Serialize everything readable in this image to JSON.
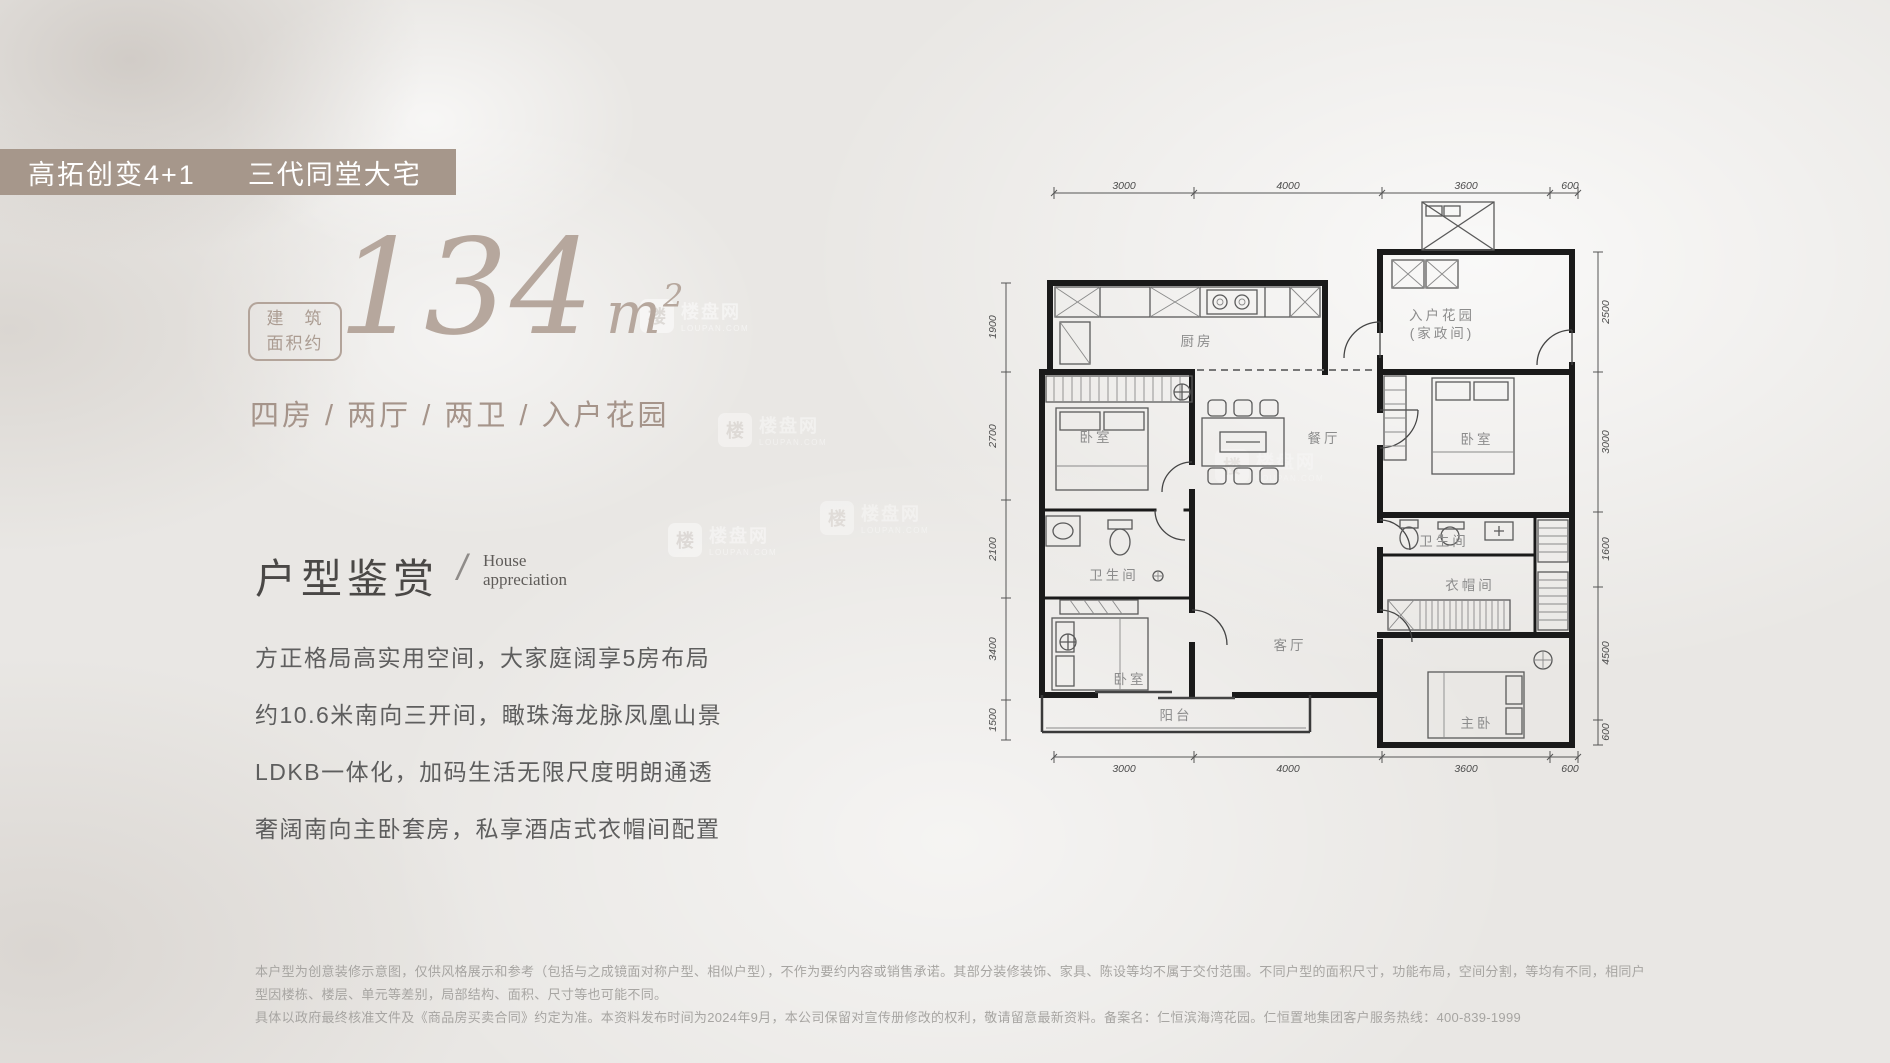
{
  "banner": {
    "part1": "高拓创变4+1",
    "part2": "三代同堂大宅"
  },
  "area": {
    "box_top": "建　筑",
    "box_bottom": "面积约",
    "value": "134",
    "unit": "m",
    "exponent": "2"
  },
  "tagline": "四房 / 两厅 / 两卫 / 入户花园",
  "section": {
    "title": "户型鉴赏",
    "slash": "/",
    "en1": "House",
    "en2": "appreciation"
  },
  "paragraph": [
    "方正格局高实用空间，大家庭阔享5房布局",
    "约10.6米南向三开间，瞰珠海龙脉凤凰山景",
    "LDKB一体化，加码生活无限尺度明朗通透",
    "奢阔南向主卧套房，私享酒店式衣帽间配置"
  ],
  "disclaimer": [
    "本户型为创意装修示意图，仅供风格展示和参考（包括与之成镜面对称户型、相似户型），不作为要约内容或销售承诺。其部分装修装饰、家具、陈设等均不属于交付范围。不同户型的面积尺寸，功能布局，空间分割，等均有不同，相同户型因楼栋、楼层、单元等差别，局部结构、面积、尺寸等也可能不同。",
    "具体以政府最终核准文件及《商品房买卖合同》约定为准。本资料发布时间为2024年9月，本公司保留对宣传册修改的权利，敬请留意最新资料。备案名：仁恒滨海湾花园。仁恒置地集团客户服务热线：400-839-1999"
  ],
  "floorplan": {
    "rooms": {
      "kitchen": "厨房",
      "garden1": "入户花园",
      "garden2": "(家政间)",
      "bedroom": "卧室",
      "dining": "餐厅",
      "bath": "卫生间",
      "living": "客厅",
      "cloak": "衣帽间",
      "master": "主卧",
      "balcony": "阳台"
    },
    "dims": {
      "top": [
        "3000",
        "4000",
        "3600",
        "600"
      ],
      "bottom": [
        "3000",
        "4000",
        "3600",
        "600"
      ],
      "left": [
        "1900",
        "2700",
        "2100",
        "3400",
        "1500"
      ],
      "right": [
        "2500",
        "3000",
        "1600",
        "4500",
        "600"
      ]
    }
  },
  "watermark": {
    "name": "楼盘网",
    "domain": "LOUPAN.COM",
    "badge": "楼"
  }
}
